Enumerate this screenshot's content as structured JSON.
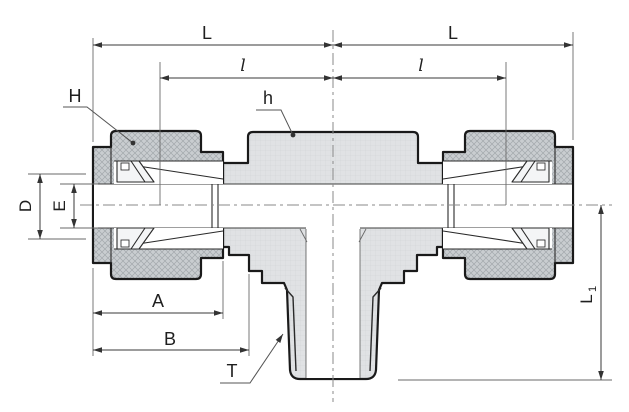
{
  "drawing": {
    "description": "Cross-section engineering drawing of a male branch tee compression tube fitting with dimension annotations",
    "labels": {
      "dim_L_left": "L",
      "dim_L_right": "L",
      "dim_l_left": "l",
      "dim_l_right": "l",
      "nut_hex_label": "H",
      "body_hex_label": "h",
      "dim_D": "D",
      "dim_E": "E",
      "dim_A": "A",
      "dim_B": "B",
      "thread_label": "T",
      "dim_L1_main": "L",
      "dim_L1_sub": "1"
    },
    "colors": {
      "outline": "#1a1a1a",
      "dimension_lines": "#3a3a3a",
      "extension_lines": "#6a6a6a",
      "centerline": "#8a8a8a",
      "nut_fill": "#c9cdd0",
      "body_fill": "#e0e2e4",
      "bore_fill": "#ffffff",
      "ferrule_fill": "#f4f5f6",
      "background": "#ffffff"
    }
  }
}
